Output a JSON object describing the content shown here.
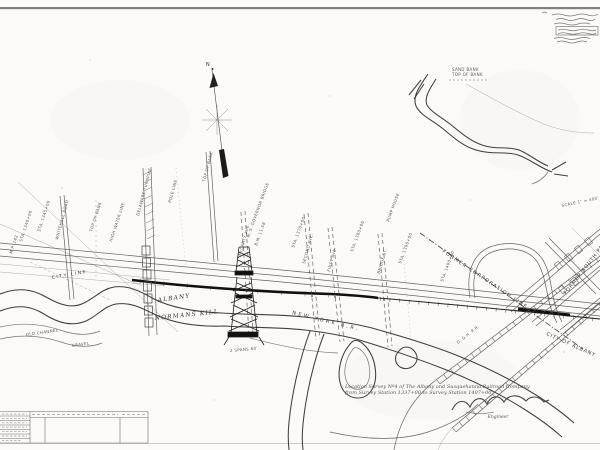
{
  "sheet": {
    "paper_color": "#fbfaf6",
    "ink_color": "#2f2f2f",
    "compass_n": "N",
    "labels": {
      "city_line": "CITY LINE",
      "albany": "ALBANY",
      "normans_kill": "NORMANS KILL",
      "new_york_rr": "NEW YORK R.R.",
      "former_corporation_line": "FORMER CORPORATION LINE",
      "former_south_pearl": "FORMER SOUTH PEARL ST.",
      "city_of_albany": "CITY OF ALBANY"
    },
    "title_block": {
      "line1": "Location Survey Nº4 of The Albany and Susquehanna Railroad Company",
      "line2": "from Survey Station 1337+00 to Survey Station 1407+00",
      "engineer": "Engineer"
    },
    "micro": [
      {
        "t": "STA. 1340+00"
      },
      {
        "t": "STA. 1345+00"
      },
      {
        "t": "M.P. 142"
      },
      {
        "t": "TOP OF BANK"
      },
      {
        "t": "HIGH WATER LINE"
      },
      {
        "t": "WHITEHALL ROAD"
      },
      {
        "t": "DELAWARE TURNPIKE"
      },
      {
        "t": "McCARTY AVE."
      },
      {
        "t": "SECOND AVE."
      },
      {
        "t": "FIRST AVE."
      },
      {
        "t": "BRIDGE ST."
      },
      {
        "t": "W. S. GOVERNOR BRIDGE"
      },
      {
        "t": "B.M. 11.58"
      },
      {
        "t": "STA. 1370+00"
      },
      {
        "t": "STA. 1380+00"
      },
      {
        "t": "STA. 1390+00"
      },
      {
        "t": "STA. 1400+00"
      },
      {
        "t": "TOP OF BANK"
      },
      {
        "t": "SAND BANK"
      },
      {
        "t": "TOP OF BANK"
      },
      {
        "t": "SCALE 1″ = 400′"
      },
      {
        "t": "PUMP HOUSE"
      },
      {
        "t": "OLD CHANNEL"
      },
      {
        "t": "GRAVEL"
      },
      {
        "t": "D. & H. R.R."
      },
      {
        "t": "POLE LINE"
      },
      {
        "t": "2 SPANS 60′"
      }
    ]
  }
}
